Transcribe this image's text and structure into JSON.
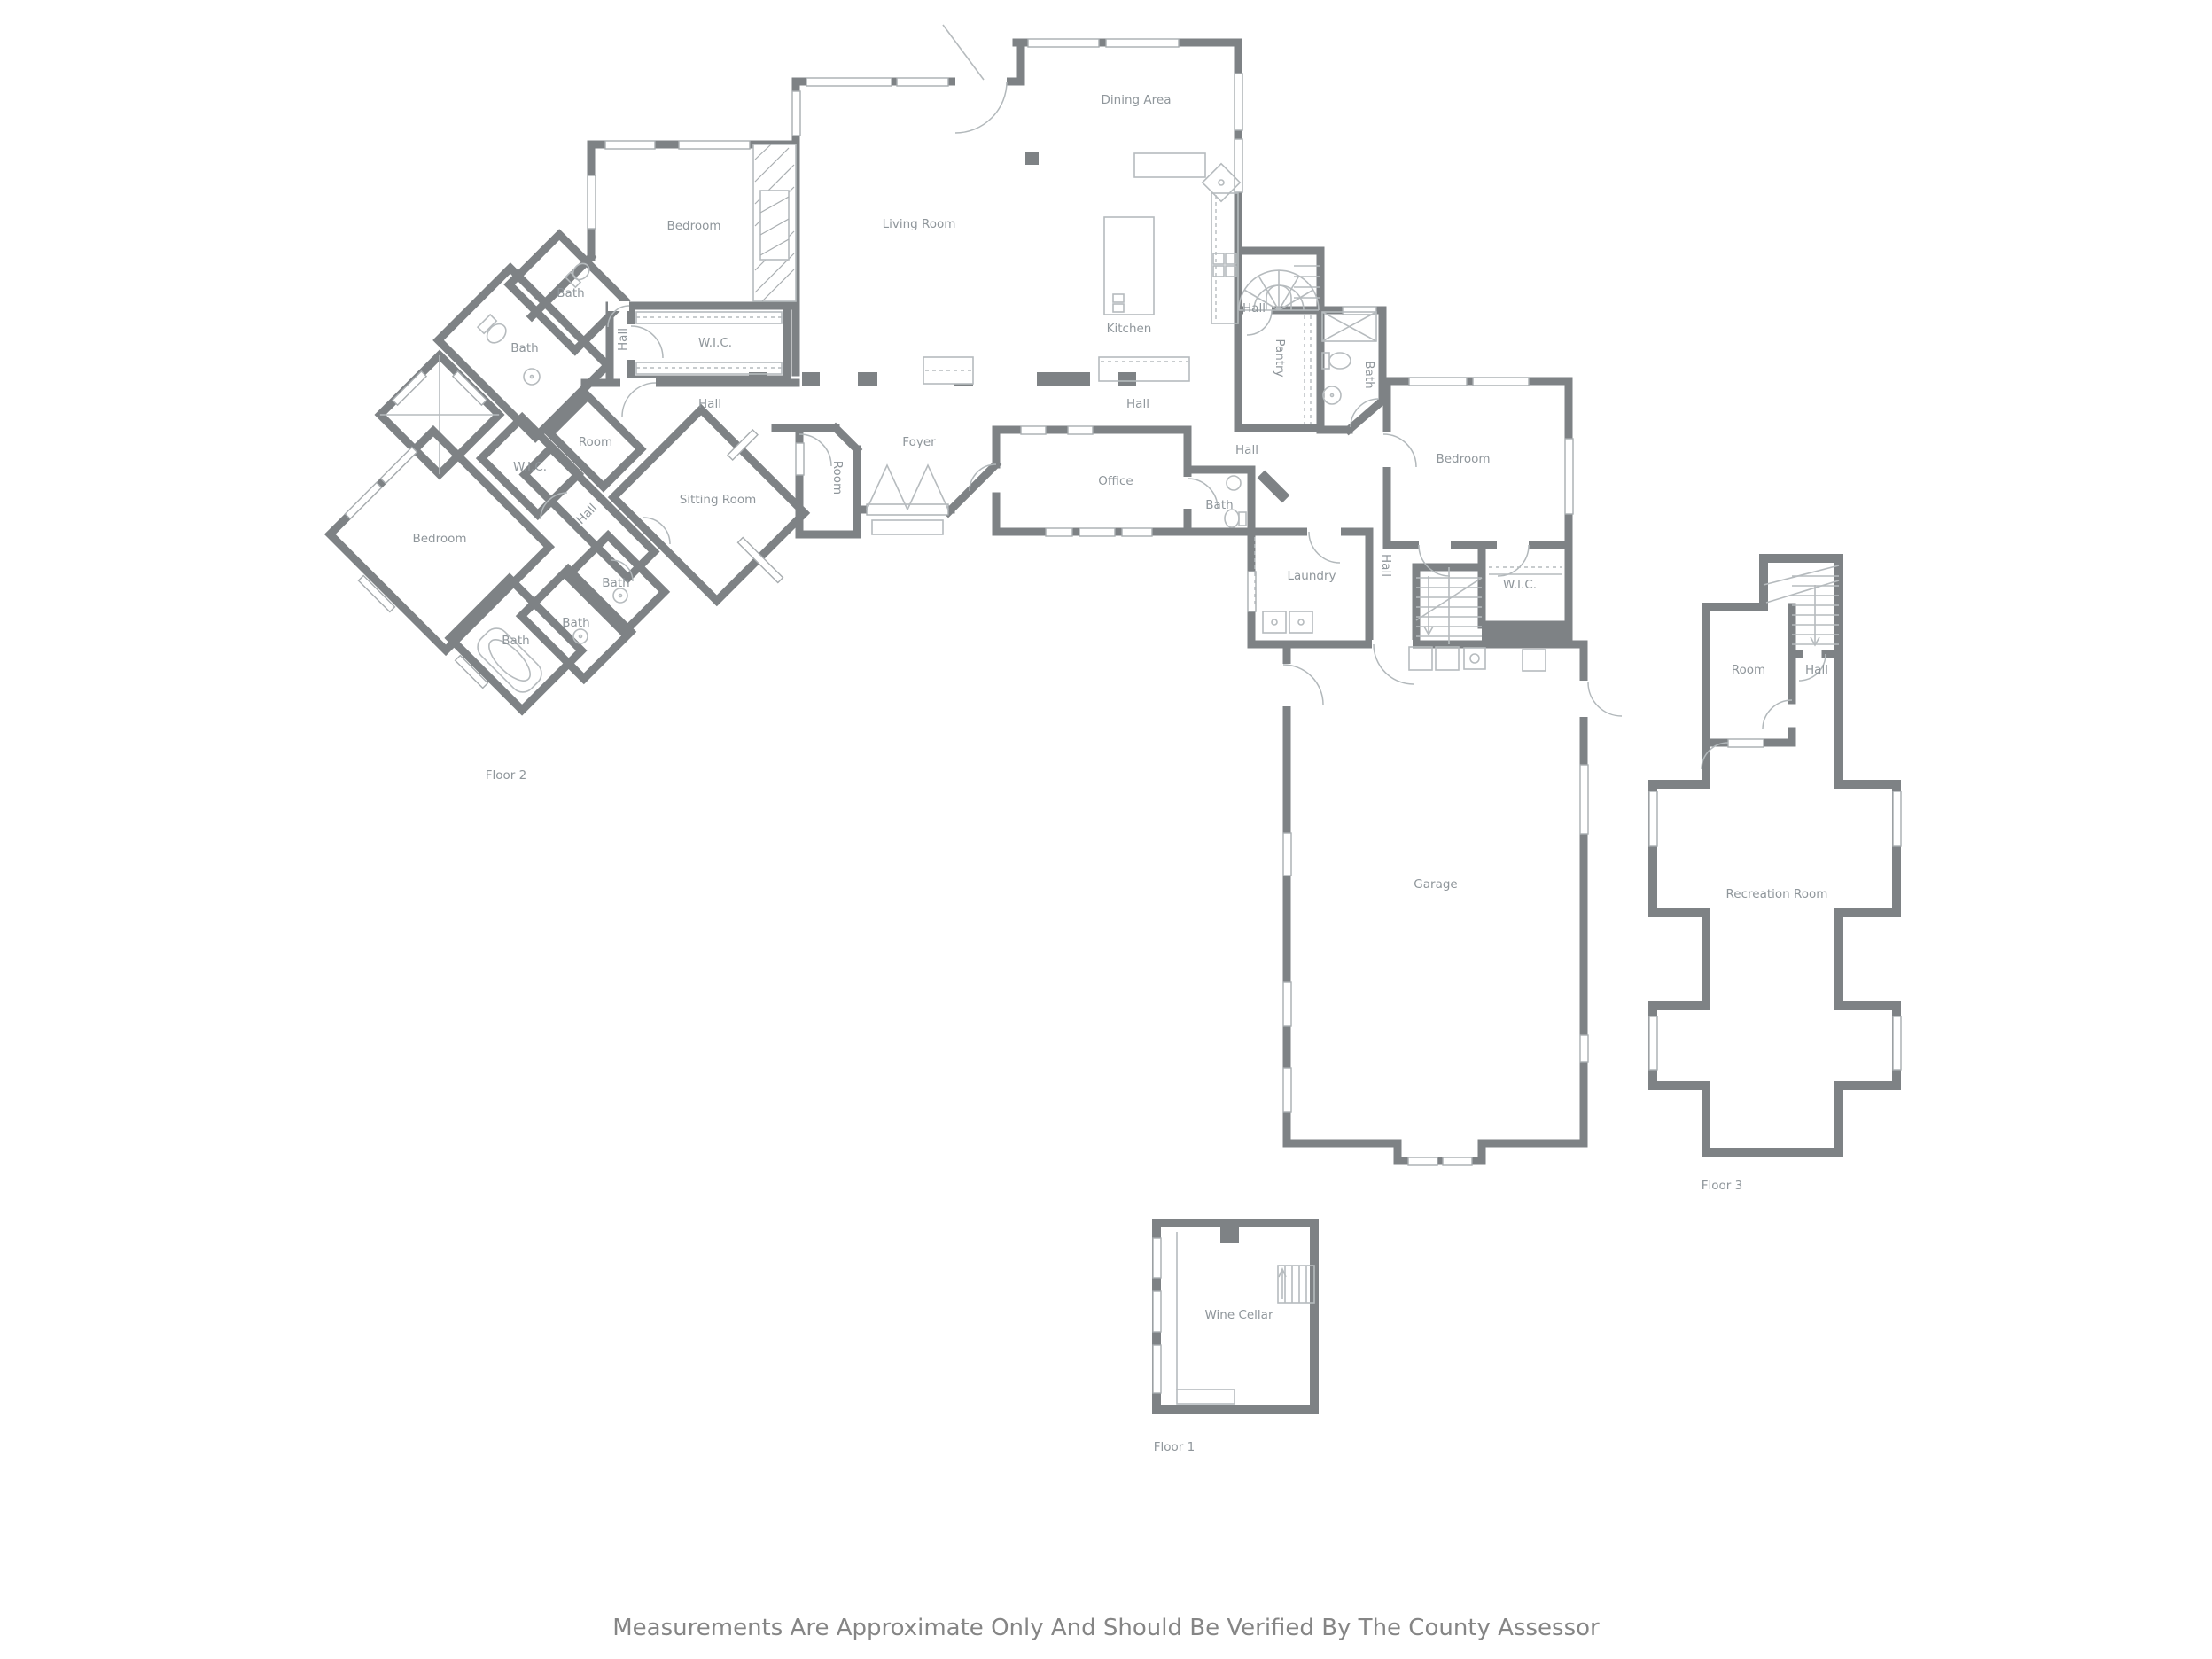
{
  "disclaimer": "Measurements Are Approximate Only And Should Be Verified By The County Assessor",
  "colors": {
    "wall": "#7e8285",
    "label": "#8f969b",
    "fixture": "#b6bbbe",
    "disclaimer_text": "#858585",
    "background": "#ffffff"
  },
  "floor2": {
    "name": "Floor 2",
    "rooms": {
      "dining": "Dining Area",
      "living": "Living Room",
      "kitchen": "Kitchen",
      "bedroom_top": "Bedroom",
      "bath_top": "Bath",
      "bath_big": "Bath",
      "hall_v_left": "Hall",
      "wic_left": "W.I.C.",
      "hall_left": "Hall",
      "hall_center": "Hall",
      "hall_stair": "Hall",
      "pantry": "Pantry",
      "bath_pantry": "Bath",
      "foyer": "Foyer",
      "room_vest": "Room",
      "office": "Office",
      "hall_right": "Hall",
      "bath_office": "Bath",
      "bedroom_right": "Bedroom",
      "hall_v_right": "Hall",
      "wic_right": "W.I.C.",
      "laundry": "Laundry",
      "room_small": "Room",
      "wic_small": "W.I.C.",
      "hall_diag": "Hall",
      "sitting": "Sitting Room",
      "bedroom_bl": "Bedroom",
      "bath1": "Bath",
      "bath2": "Bath",
      "bath3": "Bath",
      "garage": "Garage"
    }
  },
  "floor3": {
    "name": "Floor 3",
    "rooms": {
      "room": "Room",
      "hall": "Hall",
      "recreation": "Recreation Room"
    }
  },
  "floor1": {
    "name": "Floor 1",
    "rooms": {
      "wine_cellar": "Wine Cellar"
    }
  }
}
